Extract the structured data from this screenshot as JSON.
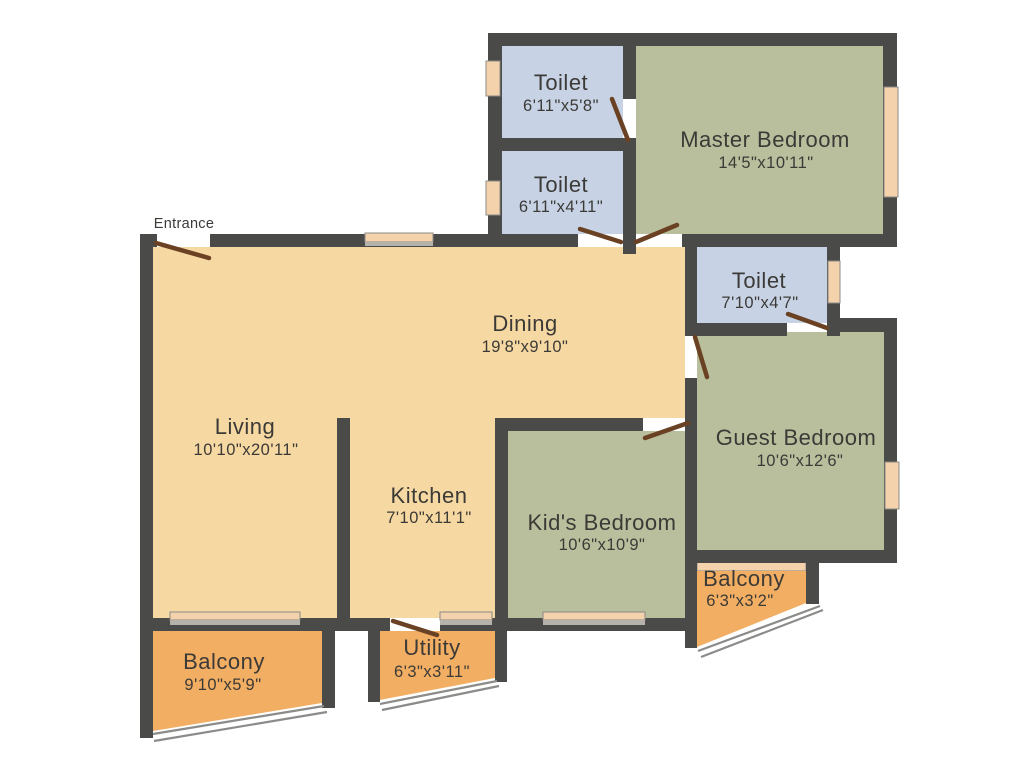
{
  "plan_title": "Apartment Floor Plan",
  "colors": {
    "background": "#ffffff",
    "wall": "#4a4a48",
    "floor_tan": "#f6d8a2",
    "floor_green": "#b9bf9c",
    "floor_blue": "#c7d3e4",
    "floor_orange": "#f2ae63",
    "window_peach": "#f4d2ab",
    "door_brown": "#6a4223",
    "railing_gray": "#8b8b89",
    "text": "#3c3a37"
  },
  "entrance": {
    "label": "Entrance"
  },
  "rooms": [
    {
      "id": "toilet-1",
      "name": "Toilet",
      "dims": "6'11\"x5'8\""
    },
    {
      "id": "toilet-2",
      "name": "Toilet",
      "dims": "6'11\"x4'11\""
    },
    {
      "id": "master-bedroom",
      "name": "Master Bedroom",
      "dims": "14'5\"x10'11\""
    },
    {
      "id": "toilet-3",
      "name": "Toilet",
      "dims": "7'10\"x4'7\""
    },
    {
      "id": "dining",
      "name": "Dining",
      "dims": "19'8\"x9'10\""
    },
    {
      "id": "living",
      "name": "Living",
      "dims": "10'10\"x20'11\""
    },
    {
      "id": "kitchen",
      "name": "Kitchen",
      "dims": "7'10\"x11'1\""
    },
    {
      "id": "kids-bedroom",
      "name": "Kid's Bedroom",
      "dims": "10'6\"x10'9\""
    },
    {
      "id": "guest-bedroom",
      "name": "Guest Bedroom",
      "dims": "10'6\"x12'6\""
    },
    {
      "id": "balcony-right",
      "name": "Balcony",
      "dims": "6'3\"x3'2\""
    },
    {
      "id": "balcony-left",
      "name": "Balcony",
      "dims": "9'10\"x5'9\""
    },
    {
      "id": "utility",
      "name": "Utility",
      "dims": "6'3\"x3'11\""
    }
  ]
}
